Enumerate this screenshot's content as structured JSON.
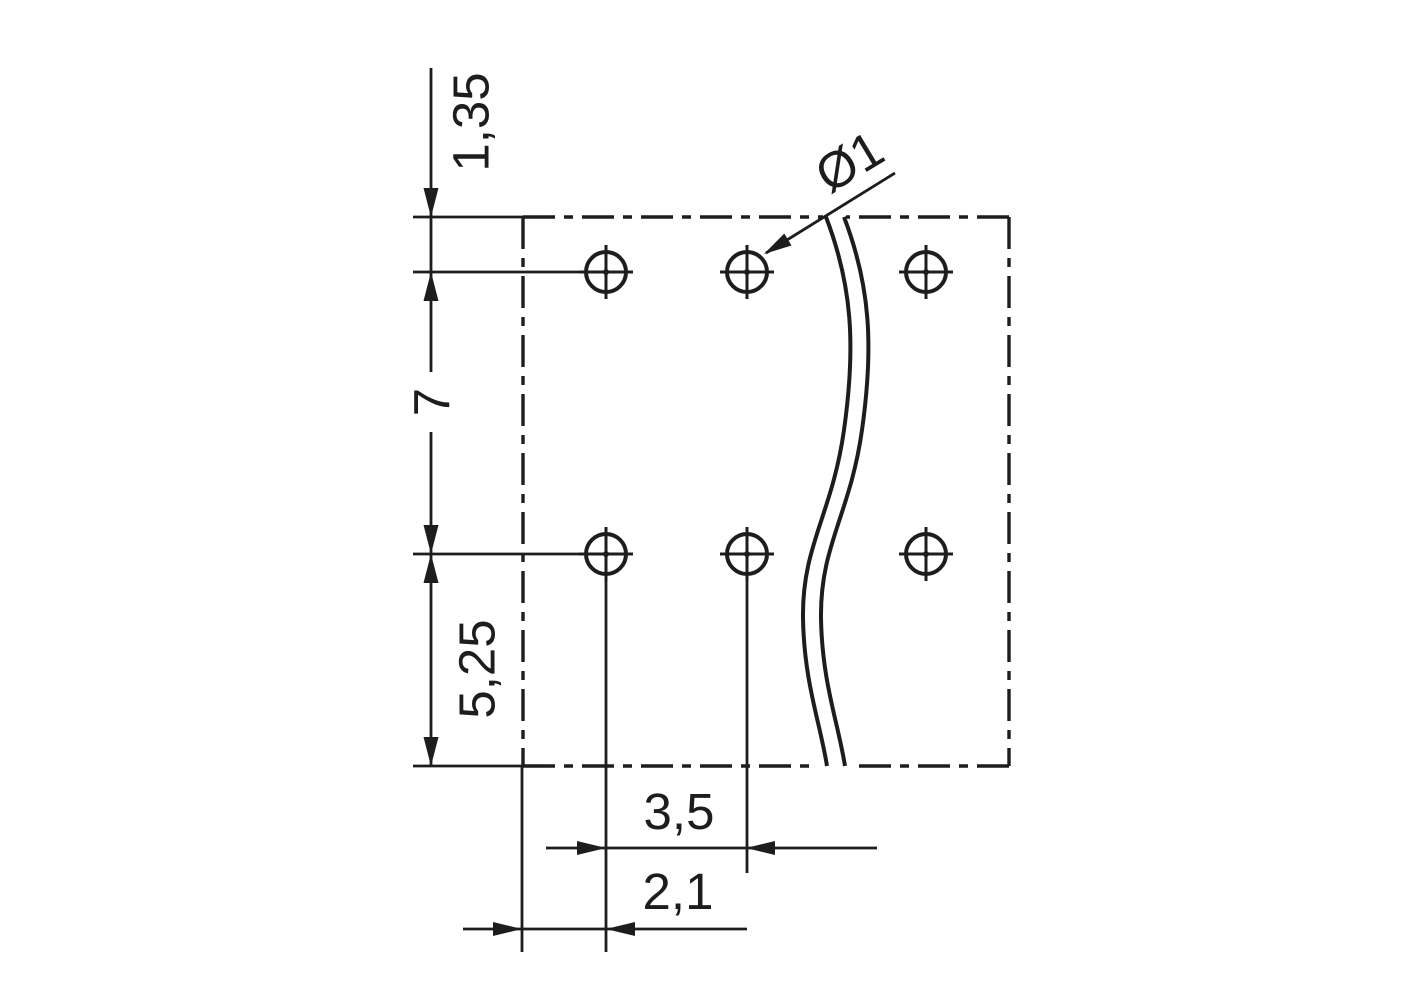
{
  "drawing": {
    "kind": "technical-dimension-drawing",
    "units_style": "comma-decimal",
    "labels": {
      "top_edge_to_first_row": "1,35",
      "row_pitch": "7",
      "second_row_to_bottom_edge": "5,25",
      "hole_pitch": "3,5",
      "left_edge_to_first_hole": "2,1",
      "hole_diameter": "Ø1"
    },
    "holes": {
      "rows": 2,
      "columns_shown": 3,
      "marker_style": "circle-with-crosshair"
    },
    "outline_style": "dash-dot (phantom/section outline) with wavy break line",
    "colors": {
      "line": "#1d1d1b",
      "background": "#ffffff"
    }
  }
}
